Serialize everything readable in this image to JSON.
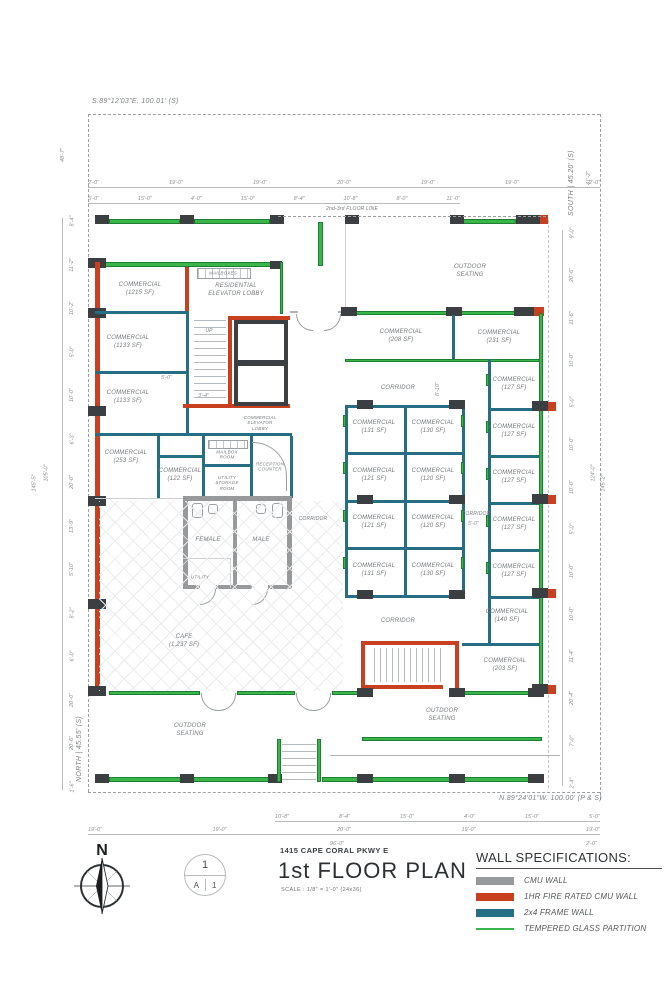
{
  "survey": {
    "bearing_top": "S.89°12'03\"E.  100.01' (S)",
    "bearing_bottom": "N.89°24'01\"W.  100.00' (P & S)",
    "bearing_west": "NORTH | 45.55' (S)",
    "bearing_east": "SOUTH | 45.20' (S)"
  },
  "notes": {
    "floor_line": "2nd-3rd FLOOR LINE",
    "up": "UP",
    "mailboxes": "MAILBOXES"
  },
  "rooms": {
    "c1215": "COMMERCIAL\n(1215 SF)",
    "res_elev_lobby": "RESIDENTIAL\nELEVATOR LOBBY",
    "c1133": "COMMERCIAL\n(1133 SF)",
    "c253": "COMMERCIAL\n(253 SF)",
    "c122": "COMMERCIAL\n(122 SF)",
    "mailbox_room": "MAILBOX\nROOM",
    "utility_storage": "UTILITY\nSTORAGE\nROOM",
    "reception": "RECEPTION\nCOUNTER",
    "com_elev_lobby": "COMMERCIAL\nELEVATOR\nLOBBY",
    "female": "FEMALE",
    "male": "MALE",
    "utility": "UTILITY",
    "cafe": "CAFE\n(1,237 SF)",
    "outdoor": "OUTDOOR\nSEATING",
    "corridor": "CORRIDOR",
    "c208": "COMMERCIAL\n(208 SF)",
    "c231": "COMMERCIAL\n(231 SF)",
    "c131": "COMMERCIAL\n(131 SF)",
    "c130": "COMMERCIAL\n(130 SF)",
    "c121": "COMMERCIAL\n(121 SF)",
    "c120": "COMMERCIAL\n(120 SF)",
    "c127": "COMMERCIAL\n(127 SF)",
    "c140": "COMMERCIAL\n(140 SF)",
    "c203": "COMMERCIAL\n(203 SF)"
  },
  "dims": {
    "top_row1": [
      "2'-0\"",
      "19'-0\"",
      "19'-0\"",
      "20'-0\"",
      "19'-0\"",
      "19'-0\"",
      "2'-0\""
    ],
    "top_row2": [
      "5'-0\"",
      "15'-0\"",
      "4'-0\"",
      "15'-0\"",
      "8'-4\"",
      "10'-8\"",
      "8'-0\"",
      "11'-0\""
    ],
    "bottom_row1": [
      "10'-8\"",
      "8'-4\"",
      "15'-0\"",
      "4'-0\"",
      "15'-0\"",
      "5'-0\""
    ],
    "bottom_row2": [
      "19'-0\"",
      "19'-0\"",
      "20'-0\"",
      "19'-0\"",
      "19'-0\""
    ],
    "bottom_row3": [
      "96'-0\"",
      "2'-0\""
    ],
    "left_col": [
      "8'-4\"",
      "11'-2\"",
      "10'-2\"",
      "5'-0\"",
      "10'-0\"",
      "6'-3\"",
      "20'-0\"",
      "13'-9\"",
      "5'-10\"",
      "8'-2\"",
      "6'-0\"",
      "20'-0\"",
      "20'-6\"",
      "1'-6\""
    ],
    "left_inner_overall": "105'-0\"",
    "left_outer_overall": "145'-5\"",
    "left_top_gap": "48'-7\"",
    "right_col": [
      "9'-0\"",
      "20'-6\"",
      "11'-6\"",
      "10'-0\"",
      "5'-0\"",
      "10'-0\"",
      "10'-0\"",
      "5'-0\"",
      "10'-0\"",
      "10'-0\"",
      "11'-4\"",
      "20'-4\"",
      "7'-0\"",
      "2'-4\""
    ],
    "right_top_gap": "41'-2\"",
    "right_inner_overall": "124'-0\"",
    "right_outer_overall": "145'-2\"",
    "corridor_w": "6'-10\"",
    "corridor_e": "5'-0\"",
    "stair_w": "5'-0\"",
    "stair_r": "3'-4\""
  },
  "titleblock": {
    "address": "1415 CAPE CORAL PKWY E",
    "title": "1st FLOOR PLAN",
    "scale": "SCALE : 1/8\" = 1'-0\" (24x36)",
    "north_letter": "N",
    "sheet_top": "1",
    "sheet_bottom_left": "A",
    "sheet_bottom_right": "1"
  },
  "legend": {
    "title": "WALL SPECIFICATIONS:",
    "items": [
      {
        "label": "CMU WALL",
        "color": "#98999b"
      },
      {
        "label": "1HR FIRE RATED CMU WALL",
        "color": "#c8401f"
      },
      {
        "label": "2x4 FRAME WALL",
        "color": "#256e84"
      },
      {
        "label": "TEMPERED GLASS PARTITION",
        "color": "#3ab54a"
      }
    ]
  },
  "colors": {
    "cmu_wall": "#98999b",
    "fire_wall": "#c8401f",
    "frame_wall": "#256e84",
    "glass_partition": "#3ab54a",
    "column": "#3b3f41"
  }
}
